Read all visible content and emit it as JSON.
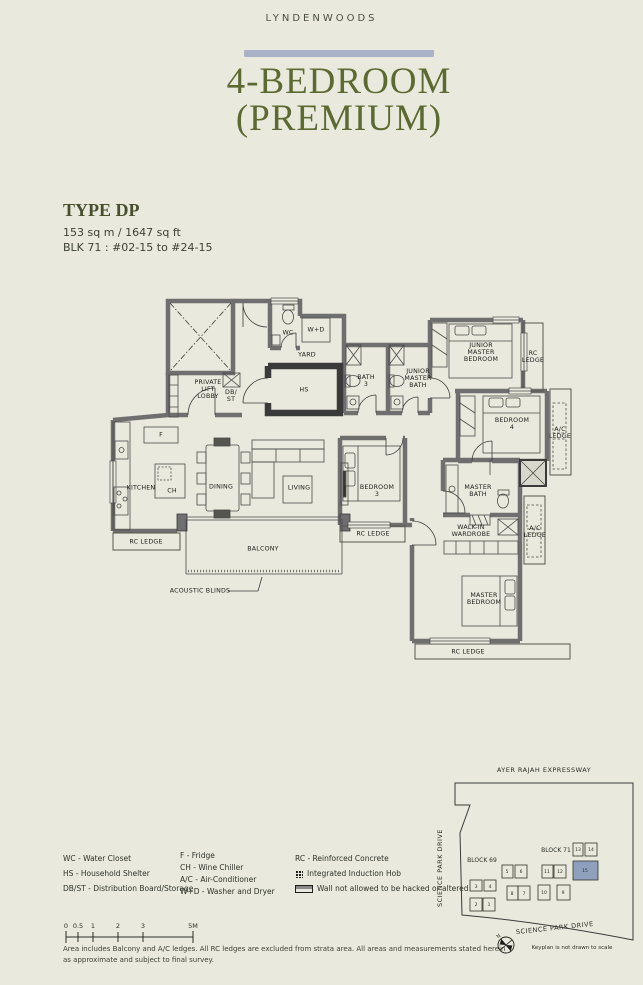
{
  "header": {
    "brand": "LYNDENWOODS",
    "title_line1": "4-BEDROOM",
    "title_line2": "(PREMIUM)"
  },
  "unit_info": {
    "type": "TYPE DP",
    "area": "153 sq m / 1647 sq ft",
    "block": "BLK 71 : #02-15 to #24-15"
  },
  "plan": {
    "labels": {
      "lobby": "PRIVATE\nLIFT\nLOBBY",
      "dbst": "DB/\nST",
      "wc": "WC",
      "wd": "W+D",
      "yard": "YARD",
      "hs": "HS",
      "bath3": "BATH\n3",
      "jm_bath": "JUNIOR\nMASTER\nBATH",
      "jm_bed": "JUNIOR\nMASTER\nBEDROOM",
      "rc_ledge_r": "RC\nLEDGE",
      "bed4": "BEDROOM\n4",
      "ac_ledge_1": "A/C\nLEDGE",
      "kitchen": "KITCHEN",
      "f": "F",
      "ch": "CH",
      "dining": "DINING",
      "living": "LIVING",
      "bed3": "BEDROOM\n3",
      "rc_ledge_bl": "RC LEDGE",
      "balcony": "BALCONY",
      "rc_ledge_m": "RC LEDGE",
      "m_bath": "MASTER\nBATH",
      "wardrobe": "WALK-IN\nWARDROBE",
      "ac_ledge_2": "A/C\nLEDGE",
      "m_bed": "MASTER\nBEDROOM",
      "rc_ledge_b": "RC LEDGE",
      "acoustic": "ACOUSTIC BLINDS"
    }
  },
  "legend": {
    "col1": [
      "WC - Water Closet",
      "HS - Household Shelter",
      "DB/ST - Distribution Board/Storage"
    ],
    "col2": [
      "F - Fridge",
      "CH - Wine Chiller",
      "A/C - Air-Conditioner",
      "W+D - Washer and Dryer"
    ],
    "rc": "RC - Reinforced Concrete",
    "hob": "Integrated Induction Hob",
    "wall": "Wall not allowed to be hacked or altered"
  },
  "scale_bar": {
    "ticks": [
      "0",
      "0.5",
      "1",
      "2",
      "3",
      "5M"
    ]
  },
  "disclaimer": "Area includes Balcony and A/C ledges. All RC ledges are excluded from strata area. All areas and measurements stated herein as approximate and subject to final survey.",
  "keyplan": {
    "expressway": "AYER RAJAH EXPRESSWAY",
    "road_left": "SCIENCE PARK DRIVE",
    "road_bottom": "SCIENCE PARK DRIVE",
    "block69": "BLOCK 69",
    "block71": "BLOCK 71",
    "note": "Keyplan is not drawn to scale",
    "compass_n": "N",
    "highlight_color": "#8f9fbe",
    "units": [
      "1",
      "2",
      "3",
      "4",
      "5",
      "6",
      "7",
      "8",
      "9",
      "10",
      "11",
      "12",
      "13",
      "14",
      "15"
    ]
  }
}
